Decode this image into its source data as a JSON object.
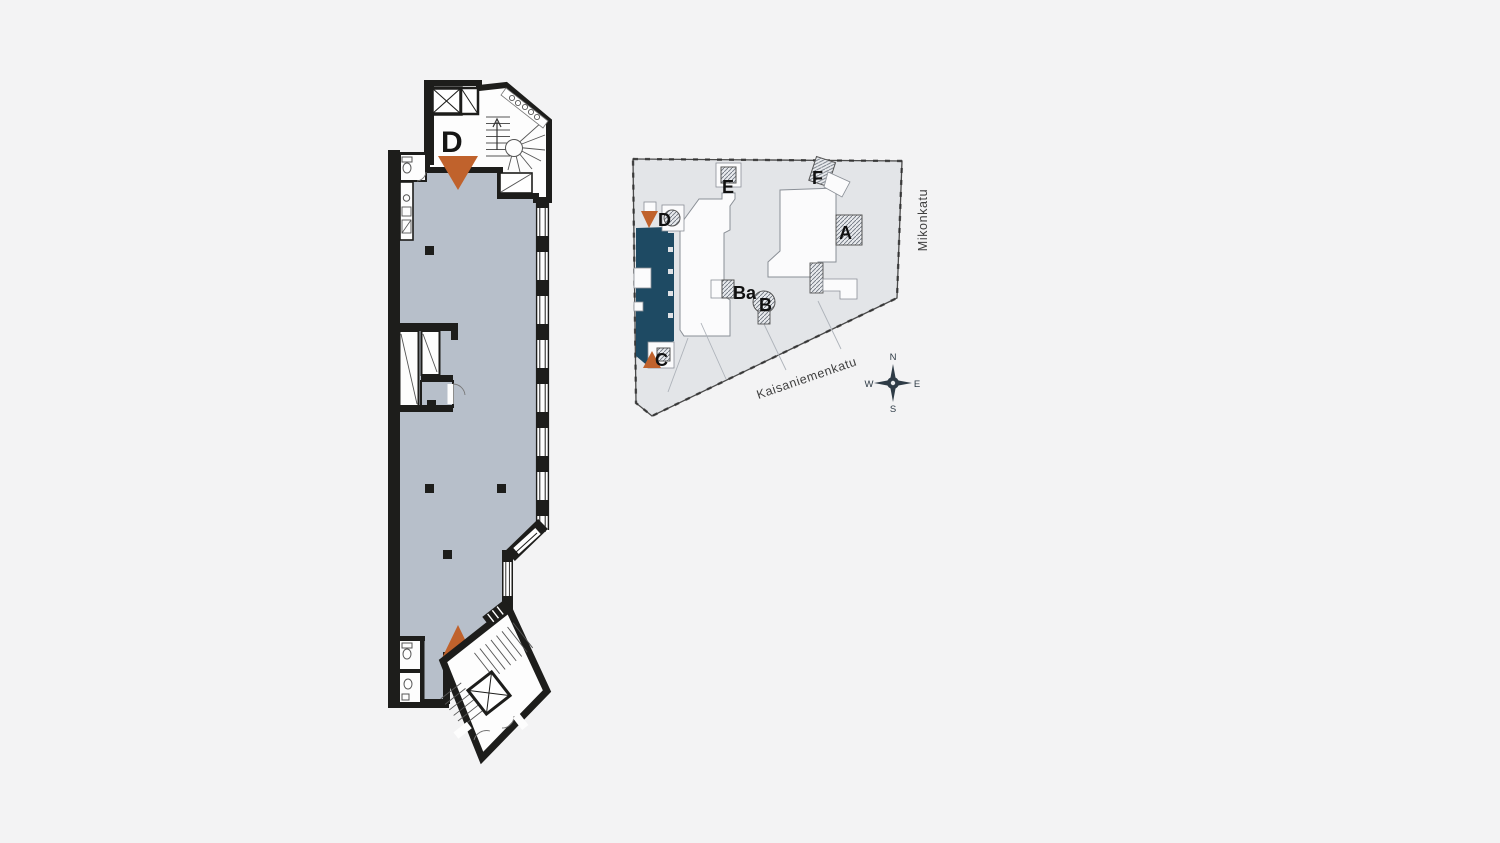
{
  "page": {
    "background_color": "#f3f3f4",
    "description": "Architectural floor plan with site overview"
  },
  "main_plan": {
    "entrances": {
      "d_label": "D",
      "c_label": "C"
    },
    "colors": {
      "floor": "#b7bfca",
      "wall": "#1d1d1b",
      "entrance_arrow": "#c0622c"
    }
  },
  "overview_plan": {
    "stairwell_labels": {
      "a": "A",
      "b": "B",
      "ba": "Ba",
      "c": "C",
      "d": "D",
      "e": "E",
      "f": "F"
    },
    "streets": {
      "east": "Mikonkatu",
      "south": "Kaisaniemenkatu"
    },
    "compass": {
      "north": "N",
      "east": "E",
      "south": "S",
      "west": "W"
    },
    "colors": {
      "building": "#e3e5e8",
      "highlighted_premises": "#1e4a63",
      "courtyard": "#fbfbfc",
      "entrance_arrow": "#c0622c"
    }
  }
}
